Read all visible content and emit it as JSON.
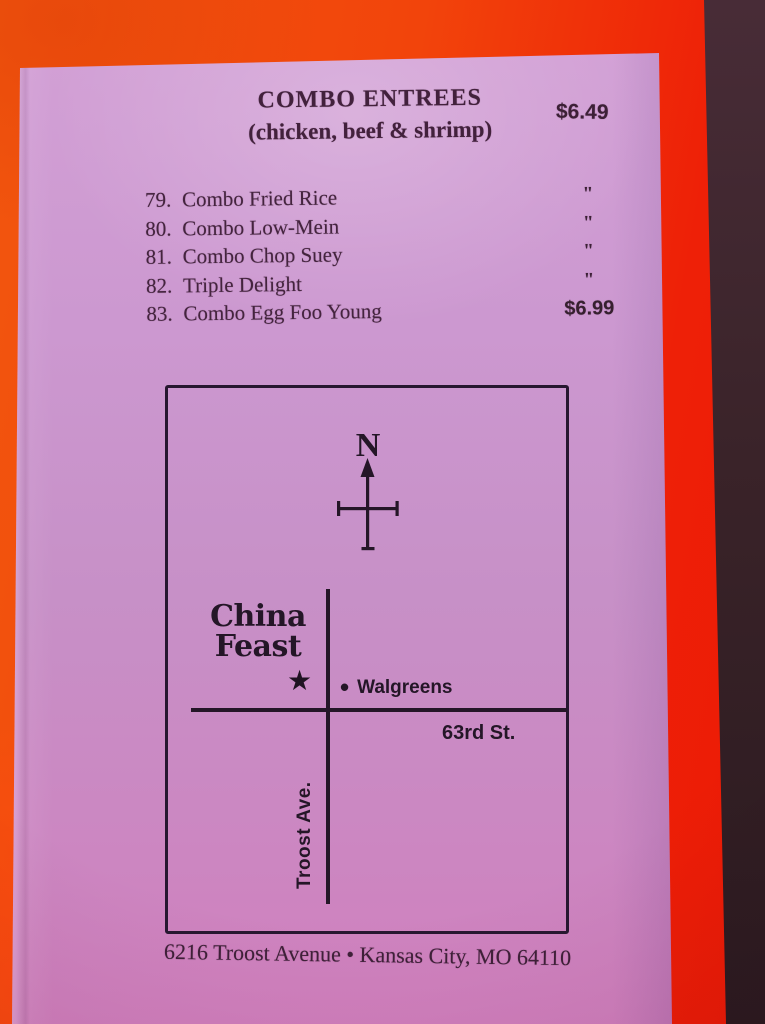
{
  "colors": {
    "background_orange": "#f2470b",
    "paper_pink": "#cb95cc",
    "ink": "#44243e",
    "map_ink": "#241627",
    "table_shadow": "#33202a"
  },
  "section": {
    "title": "COMBO ENTREES",
    "subtitle": "(chicken, beef & shrimp)",
    "price": "$6.49"
  },
  "items": [
    {
      "number": "79.",
      "name": "Combo Fried Rice",
      "price": "\""
    },
    {
      "number": "80.",
      "name": "Combo Low-Mein",
      "price": "\""
    },
    {
      "number": "81.",
      "name": "Combo Chop Suey",
      "price": "\""
    },
    {
      "number": "82.",
      "name": "Triple Delight",
      "price": "\""
    },
    {
      "number": "83.",
      "name": "Combo Egg Foo Young",
      "price": "$6.99"
    }
  ],
  "map": {
    "compass_label": "N",
    "restaurant_line1": "China",
    "restaurant_line2": "Feast",
    "star_glyph": "★",
    "dot_glyph": "•",
    "landmark": "Walgreens",
    "cross_street": "63rd St.",
    "main_street": "Troost Ave."
  },
  "footer": {
    "address": "6216 Troost Avenue • Kansas City, MO 64110"
  }
}
